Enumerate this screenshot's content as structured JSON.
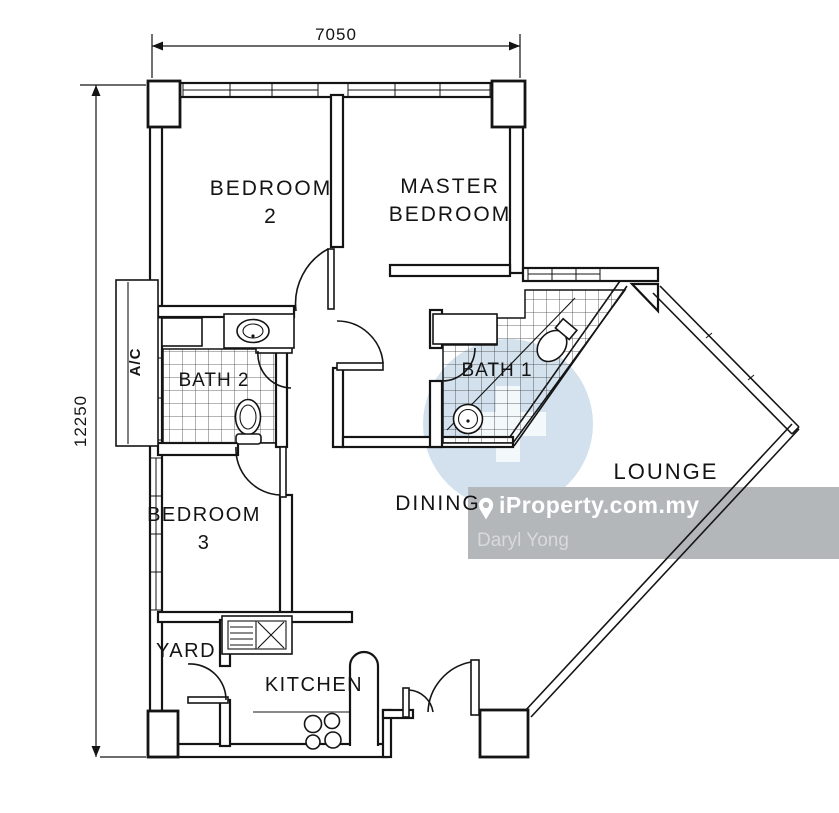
{
  "plan": {
    "dimensions": {
      "width": "7050",
      "height": "12250"
    },
    "rooms": {
      "bedroom2": {
        "line1": "BEDROOM",
        "line2": "2"
      },
      "master": {
        "line1": "MASTER",
        "line2": "BEDROOM"
      },
      "bedroom3": {
        "line1": "BEDROOM",
        "line2": "3"
      },
      "bath1": {
        "label": "BATH 1"
      },
      "bath2": {
        "label": "BATH 2"
      },
      "ac": {
        "label": "A/C"
      },
      "dining": {
        "label": "DINING"
      },
      "lounge": {
        "label": "LOUNGE"
      },
      "yard": {
        "label": "YARD"
      },
      "kitchen": {
        "label": "KITCHEN"
      }
    }
  },
  "watermark": {
    "brand": "iProperty.com.my",
    "agent": "Daryl Yong",
    "colors": {
      "box": "#b4b7ba",
      "brand_text": "#ffffff",
      "agent_text": "#d7d9db",
      "logo_blue": "#aecadf",
      "logo_cross": "#f2f7fa"
    }
  }
}
